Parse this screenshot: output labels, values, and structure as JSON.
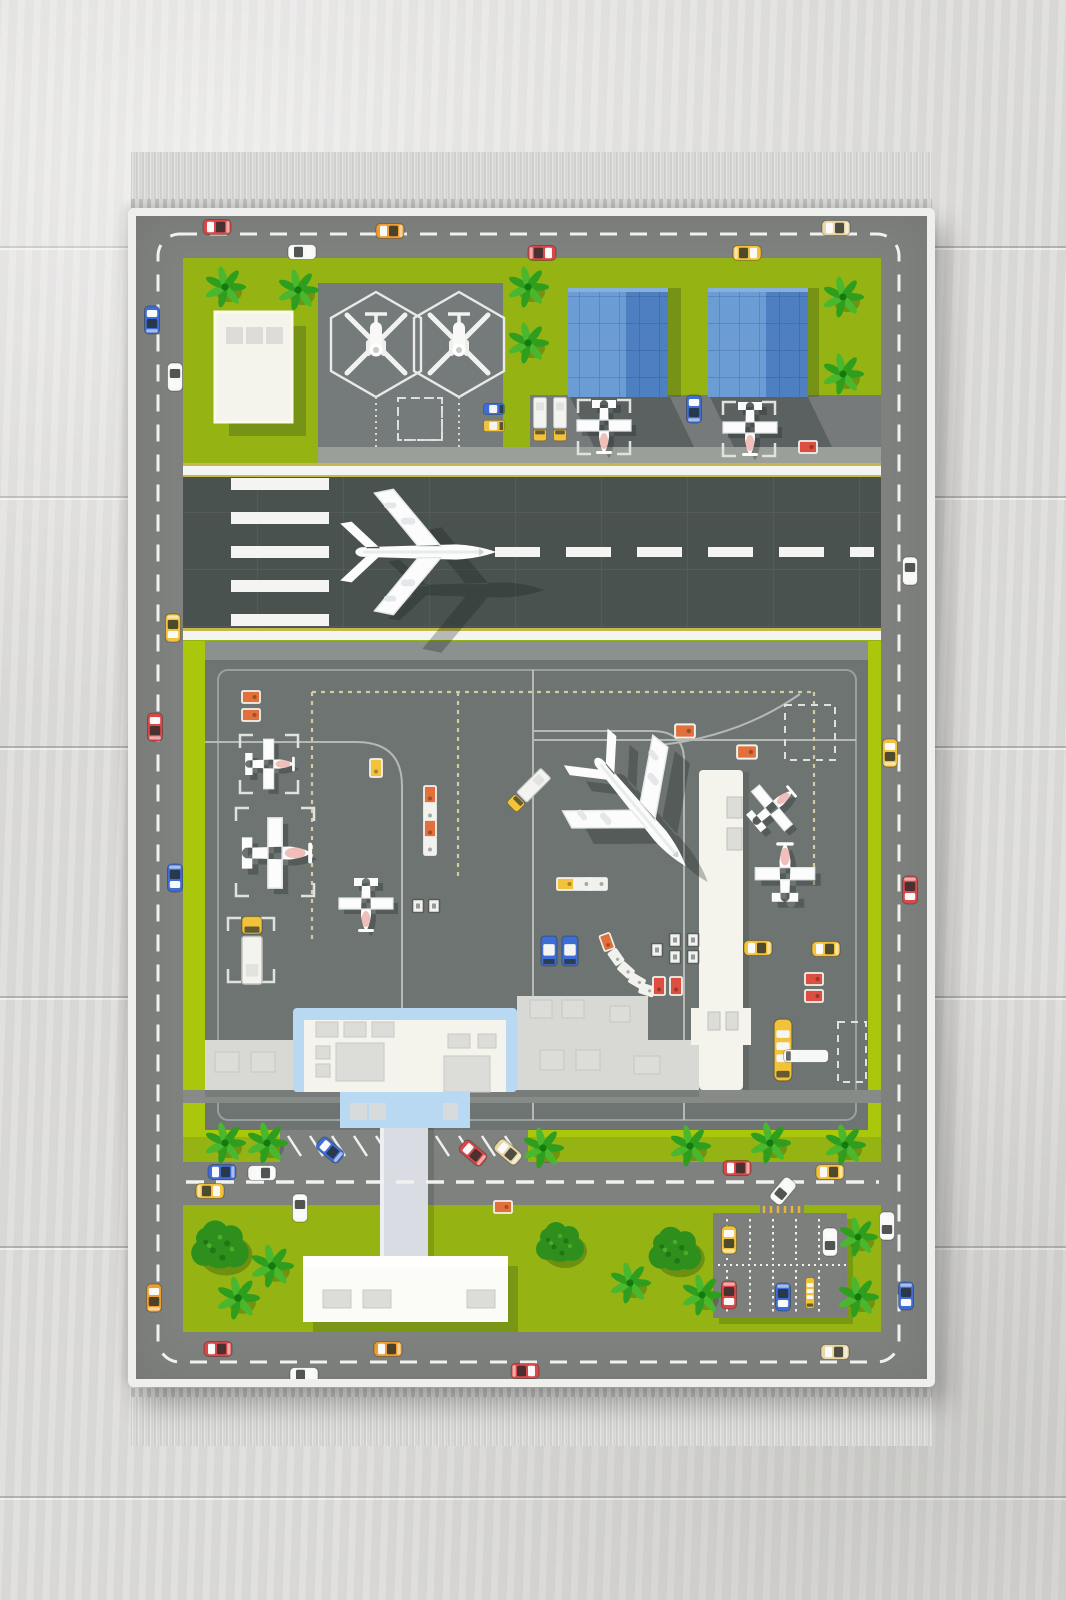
{
  "description": "kids airport road play rug with fringe, laid on light gray wooden floor",
  "colors": {
    "floor": "#dedddb",
    "binding": "#efefed",
    "road": "#7e817e",
    "road_dash": "#f1f1ef",
    "grass": "#95b413",
    "grass_bright": "#abc70b",
    "pad": "#757a7a",
    "shoulder": "#9aa099",
    "runway": "#4a5250",
    "runway_white": "#f4f5f3",
    "runway_yellow": "#c3b94e",
    "apron": "#6e7472",
    "apron_top": "#8b918e",
    "apron_line": "#c2c5c1",
    "apron_grid": "#9aa09d",
    "taxi_dash": "#d4cc9e",
    "ivory": "#f4f3ec",
    "terminal_blue": "#b9d8f2",
    "wing_gray": "#d8d9d5",
    "roof_rect": "#dcdcd8",
    "walkway": "#dadce3",
    "bldg_blue_light": "#6c9cd4",
    "bldg_blue_dark": "#4d7fc1",
    "tree_green": "#2e9e1f",
    "tree_green_light": "#49b82e",
    "bush_green": "#2e8f1d",
    "plane_white": "#fbfcfb",
    "plane_shade": "#e3e7ea",
    "plane_pink": "#eeb4ae"
  },
  "car_colors": {
    "red": "#d94848",
    "orange": "#ee9d2f",
    "yellow": "#f2c23a",
    "blue": "#3e6ed4",
    "white": "#f7f7f5",
    "beige": "#e9d7a5",
    "lugg": "#e2703a",
    "whitec": "#f1f1ed",
    "redc": "#dc4f40"
  },
  "scene": {
    "cars": [
      [
        217,
        227,
        0,
        "red"
      ],
      [
        390,
        231,
        0,
        "orange"
      ],
      [
        836,
        228,
        0,
        "beige"
      ],
      [
        302,
        252,
        180,
        "white"
      ],
      [
        542,
        253,
        180,
        "red"
      ],
      [
        747,
        253,
        180,
        "yellow"
      ],
      [
        152,
        320,
        90,
        "blue"
      ],
      [
        175,
        377,
        270,
        "white"
      ],
      [
        173,
        628,
        270,
        "yellow"
      ],
      [
        155,
        727,
        90,
        "red"
      ],
      [
        175,
        878,
        270,
        "blue"
      ],
      [
        154,
        1298,
        90,
        "orange"
      ],
      [
        910,
        571,
        270,
        "white"
      ],
      [
        890,
        753,
        90,
        "yellow"
      ],
      [
        910,
        890,
        270,
        "red"
      ],
      [
        887,
        1226,
        90,
        "white"
      ],
      [
        906,
        1296,
        270,
        "blue"
      ],
      [
        218,
        1349,
        0,
        "red"
      ],
      [
        388,
        1349,
        0,
        "orange"
      ],
      [
        304,
        1375,
        180,
        "white"
      ],
      [
        525,
        1371,
        180,
        "red"
      ],
      [
        835,
        1352,
        0,
        "beige"
      ],
      [
        330,
        1150,
        40,
        "blue"
      ],
      [
        473,
        1153,
        40,
        "red"
      ],
      [
        508,
        1152,
        40,
        "beige"
      ],
      [
        222,
        1172,
        0,
        "blue"
      ],
      [
        262,
        1173,
        0,
        "white"
      ],
      [
        210,
        1191,
        180,
        "yellow"
      ],
      [
        300,
        1208,
        270,
        "white"
      ],
      [
        737,
        1168,
        0,
        "red"
      ],
      [
        830,
        1172,
        0,
        "yellow"
      ],
      [
        783,
        1191,
        130,
        "white"
      ],
      [
        729,
        1240,
        90,
        "yellow"
      ],
      [
        830,
        1242,
        90,
        "white"
      ],
      [
        729,
        1295,
        270,
        "red"
      ],
      [
        783,
        1297,
        270,
        "blue"
      ],
      [
        694,
        409,
        90,
        "blue"
      ],
      [
        758,
        948,
        0,
        "yellow"
      ],
      [
        826,
        949,
        0,
        "yellow"
      ]
    ],
    "vans": [
      [
        494,
        409,
        0,
        "blue",
        0.8
      ],
      [
        494,
        426,
        0,
        "yellow",
        0.8
      ],
      [
        549,
        951,
        90,
        "blue",
        1.15
      ],
      [
        570,
        951,
        90,
        "blue",
        1.15
      ]
    ],
    "trucks": [
      [
        540,
        420,
        0,
        "yellow",
        0.8
      ],
      [
        560,
        420,
        0,
        "yellow",
        0.8
      ],
      [
        252,
        949,
        180,
        "yellow",
        1.25
      ],
      [
        528,
        791,
        45,
        "yellow",
        0.9
      ]
    ],
    "buses": [
      [
        783,
        1050,
        0,
        "yellow",
        1.1
      ],
      [
        810,
        1293,
        0,
        "yellow",
        0.55
      ],
      [
        806,
        1056,
        90,
        "white",
        0.8
      ]
    ],
    "carts": [
      [
        251,
        697,
        0,
        "lugg",
        1
      ],
      [
        251,
        715,
        0,
        "lugg",
        1
      ],
      [
        376,
        768,
        90,
        "yellow",
        1
      ],
      [
        430,
        795,
        90,
        "lugg",
        1
      ],
      [
        430,
        812,
        90,
        "whitec",
        1
      ],
      [
        430,
        829,
        90,
        "lugg",
        1
      ],
      [
        430,
        846,
        90,
        "whitec",
        1
      ],
      [
        566,
        884,
        0,
        "yellow",
        1
      ],
      [
        583,
        884,
        0,
        "whitec",
        1
      ],
      [
        598,
        884,
        0,
        "whitec",
        1
      ],
      [
        607,
        942,
        70,
        "lugg",
        0.9
      ],
      [
        616,
        957,
        55,
        "whitec",
        0.8
      ],
      [
        626,
        970,
        42,
        "whitec",
        0.8
      ],
      [
        637,
        981,
        30,
        "whitec",
        0.8
      ],
      [
        647,
        990,
        18,
        "whitec",
        0.8
      ],
      [
        659,
        986,
        90,
        "redc",
        1
      ],
      [
        676,
        986,
        90,
        "redc",
        1
      ],
      [
        814,
        979,
        0,
        "redc",
        1
      ],
      [
        814,
        996,
        0,
        "redc",
        1
      ],
      [
        808,
        447,
        0,
        "redc",
        1
      ],
      [
        685,
        731,
        0,
        "lugg",
        1.1
      ],
      [
        747,
        752,
        0,
        "lugg",
        1.1
      ],
      [
        503,
        1207,
        0,
        "lugg",
        1
      ]
    ],
    "dollies": [
      [
        418,
        906
      ],
      [
        434,
        906
      ],
      [
        675,
        940
      ],
      [
        693,
        940
      ],
      [
        675,
        957
      ],
      [
        693,
        957
      ],
      [
        657,
        950
      ]
    ],
    "trees": [
      [
        "palm",
        225,
        287,
        1
      ],
      [
        "palm",
        298,
        290,
        1
      ],
      [
        "palm",
        528,
        287,
        1
      ],
      [
        "palm",
        528,
        343,
        1
      ],
      [
        "palm",
        843,
        297,
        1
      ],
      [
        "palm",
        843,
        374,
        1
      ],
      [
        "palm",
        225,
        1143,
        1
      ],
      [
        "palm",
        267,
        1143,
        1
      ],
      [
        "palm",
        543,
        1148,
        1
      ],
      [
        "palm",
        690,
        1146,
        1
      ],
      [
        "palm",
        770,
        1143,
        1
      ],
      [
        "palm",
        845,
        1145,
        1
      ],
      [
        "palm",
        272,
        1266,
        1.05
      ],
      [
        "palm",
        238,
        1298,
        1.05
      ],
      [
        "palm",
        630,
        1283,
        1
      ],
      [
        "palm",
        702,
        1295,
        1
      ],
      [
        "palm",
        858,
        1237,
        0.95
      ],
      [
        "palm",
        858,
        1297,
        1
      ],
      [
        "bush",
        220,
        1248,
        1.2
      ],
      [
        "bush",
        560,
        1245,
        1.0
      ],
      [
        "bush",
        675,
        1252,
        1.1
      ]
    ],
    "planes": [
      {
        "t": "jet",
        "x": 420,
        "y": 552,
        "r": 0,
        "s": 0.95,
        "sdx": 48,
        "sdy": 38
      },
      {
        "t": "jet",
        "x": 637,
        "y": 808,
        "r": 50,
        "s": 0.95,
        "sdx": 22,
        "sdy": 16
      },
      {
        "t": "prop",
        "x": 270,
        "y": 764,
        "r": 0,
        "s": 0.92,
        "sdx": 5,
        "sdy": 5
      },
      {
        "t": "prop",
        "x": 277,
        "y": 853,
        "r": 0,
        "s": 1.3,
        "sdx": 6,
        "sdy": 6
      },
      {
        "t": "prop",
        "x": 366,
        "y": 905,
        "r": 90,
        "s": 1.0,
        "sdx": 5,
        "sdy": 5
      },
      {
        "t": "prop",
        "x": 604,
        "y": 427,
        "r": 90,
        "s": 1.0,
        "sdx": 5,
        "sdy": 5
      },
      {
        "t": "prop",
        "x": 750,
        "y": 429,
        "r": 90,
        "s": 1.0,
        "sdx": 5,
        "sdy": 5
      },
      {
        "t": "prop",
        "x": 773,
        "y": 807,
        "r": -40,
        "s": 0.95,
        "sdx": 5,
        "sdy": 5
      },
      {
        "t": "prop",
        "x": 785,
        "y": 872,
        "r": -90,
        "s": 1.1,
        "sdx": 6,
        "sdy": 6
      },
      {
        "t": "heli",
        "x": 376,
        "y": 344,
        "r": 0,
        "s": 1.0,
        "sdx": 3,
        "sdy": 3
      },
      {
        "t": "heli",
        "x": 459,
        "y": 344,
        "r": 0,
        "s": 1.0,
        "sdx": 3,
        "sdy": 3
      }
    ],
    "brackets": {
      "solid": [
        [
          240,
          735,
          58,
          58
        ],
        [
          236,
          808,
          78,
          88
        ],
        [
          228,
          918,
          46,
          64
        ],
        [
          578,
          400,
          52,
          54
        ],
        [
          723,
          402,
          52,
          54
        ]
      ],
      "dashed": [
        [
          398,
          398,
          44,
          42
        ],
        [
          785,
          705,
          50,
          55
        ],
        [
          838,
          1022,
          28,
          60
        ]
      ]
    },
    "runway": {
      "stripes": {
        "x": 231,
        "w": 98,
        "h": 12,
        "ys": [
          478,
          512,
          546,
          580,
          614
        ]
      },
      "dash": {
        "y": 547,
        "h": 10,
        "from": 495,
        "to": 874,
        "len": 45,
        "gap": 26
      }
    },
    "angle_marks": [
      {
        "from": 288,
        "y": 1136,
        "count": 5,
        "step": 22,
        "dx": 13,
        "dy": 20
      },
      {
        "from": 436,
        "y": 1136,
        "count": 4,
        "step": 23,
        "dx": 13,
        "dy": 20
      }
    ],
    "parking": {
      "cols": [
        727,
        750,
        773,
        796,
        819
      ],
      "row_top": [
        1219,
        1260
      ],
      "row_bottom": [
        1270,
        1312
      ],
      "divider": {
        "y": 1265,
        "x0": 718,
        "x1": 846
      },
      "ticks": {
        "from": 764,
        "count": 6,
        "step": 7,
        "y0": 1206,
        "y1": 1213
      }
    }
  }
}
